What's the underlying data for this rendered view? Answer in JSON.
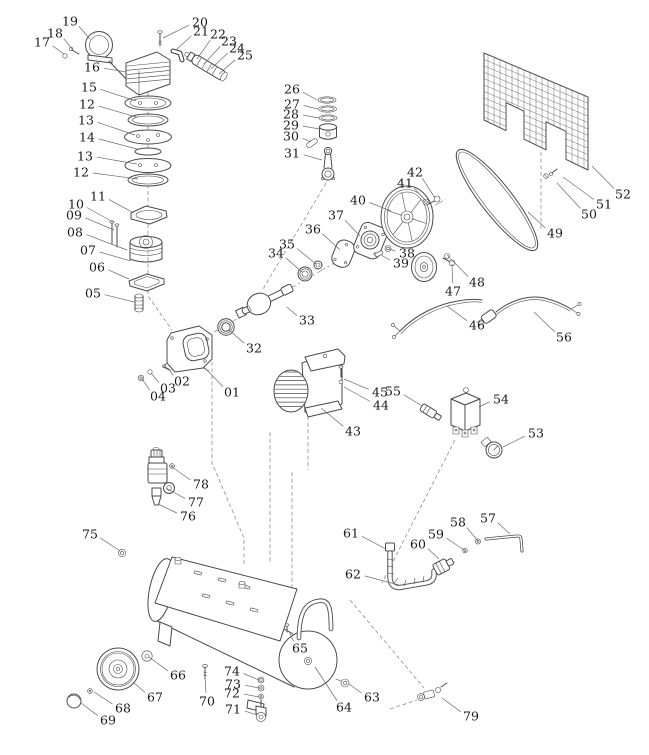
{
  "colors": {
    "line": "#4a4a4a",
    "dash": "#8f8f8f",
    "label": "#1a1a1a",
    "background": "#ffffff"
  },
  "labels": [
    {
      "t": "01",
      "x": 232,
      "y": 392,
      "tx": 204,
      "ty": 367
    },
    {
      "t": "02",
      "x": 182,
      "y": 381,
      "tx": 169,
      "ty": 369
    },
    {
      "t": "03",
      "x": 168,
      "y": 388,
      "tx": 151,
      "ty": 373
    },
    {
      "t": "04",
      "x": 158,
      "y": 396,
      "tx": 142,
      "ty": 379
    },
    {
      "t": "05",
      "x": 93,
      "y": 293,
      "tx": 134,
      "ty": 302
    },
    {
      "t": "06",
      "x": 97,
      "y": 267,
      "tx": 129,
      "ty": 279
    },
    {
      "t": "07",
      "x": 88,
      "y": 250,
      "tx": 131,
      "ty": 261
    },
    {
      "t": "08",
      "x": 75,
      "y": 232,
      "tx": 127,
      "ty": 250
    },
    {
      "t": "09",
      "x": 74,
      "y": 215,
      "tx": 114,
      "ty": 230
    },
    {
      "t": "10",
      "x": 76,
      "y": 204,
      "tx": 113,
      "ty": 222
    },
    {
      "t": "11",
      "x": 98,
      "y": 196,
      "tx": 132,
      "ty": 212
    },
    {
      "t": "12",
      "x": 87,
      "y": 104,
      "tx": 136,
      "ty": 117
    },
    {
      "t": "13",
      "x": 86,
      "y": 120,
      "tx": 135,
      "ty": 135
    },
    {
      "t": "14",
      "x": 87,
      "y": 137,
      "tx": 137,
      "ty": 149
    },
    {
      "t": "13",
      "x": 85,
      "y": 156,
      "tx": 137,
      "ty": 164
    },
    {
      "t": "12",
      "x": 81,
      "y": 172,
      "tx": 138,
      "ty": 179
    },
    {
      "t": "15",
      "x": 89,
      "y": 87,
      "tx": 136,
      "ty": 101
    },
    {
      "t": "16",
      "x": 92,
      "y": 67,
      "tx": 126,
      "ty": 72
    },
    {
      "t": "17",
      "x": 42,
      "y": 42,
      "tx": 64,
      "ty": 54
    },
    {
      "t": "18",
      "x": 55,
      "y": 33,
      "tx": 73,
      "ty": 50
    },
    {
      "t": "19",
      "x": 70,
      "y": 21,
      "tx": 90,
      "ty": 39
    },
    {
      "t": "20",
      "x": 200,
      "y": 22,
      "tx": 163,
      "ty": 38
    },
    {
      "t": "21",
      "x": 201,
      "y": 31,
      "tx": 176,
      "ty": 50
    },
    {
      "t": "22",
      "x": 218,
      "y": 34,
      "tx": 197,
      "ty": 59
    },
    {
      "t": "23",
      "x": 229,
      "y": 41,
      "tx": 204,
      "ty": 64
    },
    {
      "t": "24",
      "x": 237,
      "y": 48,
      "tx": 211,
      "ty": 69
    },
    {
      "t": "25",
      "x": 245,
      "y": 55,
      "tx": 219,
      "ty": 74
    },
    {
      "t": "26",
      "x": 292,
      "y": 89,
      "tx": 317,
      "ty": 100
    },
    {
      "t": "27",
      "x": 292,
      "y": 104,
      "tx": 318,
      "ty": 109
    },
    {
      "t": "28",
      "x": 291,
      "y": 114,
      "tx": 319,
      "ty": 118
    },
    {
      "t": "29",
      "x": 291,
      "y": 125,
      "tx": 320,
      "ty": 129
    },
    {
      "t": "30",
      "x": 291,
      "y": 136,
      "tx": 311,
      "ty": 142
    },
    {
      "t": "31",
      "x": 292,
      "y": 153,
      "tx": 322,
      "ty": 160
    },
    {
      "t": "32",
      "x": 254,
      "y": 348,
      "tx": 229,
      "ty": 330
    },
    {
      "t": "33",
      "x": 307,
      "y": 320,
      "tx": 287,
      "ty": 307
    },
    {
      "t": "34",
      "x": 276,
      "y": 253,
      "tx": 302,
      "ty": 272
    },
    {
      "t": "35",
      "x": 287,
      "y": 244,
      "tx": 316,
      "ty": 264
    },
    {
      "t": "36",
      "x": 313,
      "y": 229,
      "tx": 340,
      "ty": 250
    },
    {
      "t": "37",
      "x": 336,
      "y": 215,
      "tx": 360,
      "ty": 236
    },
    {
      "t": "38",
      "x": 407,
      "y": 253,
      "tx": 390,
      "ty": 249
    },
    {
      "t": "39",
      "x": 401,
      "y": 263,
      "tx": 381,
      "ty": 255
    },
    {
      "t": "40",
      "x": 358,
      "y": 200,
      "tx": 391,
      "ty": 211
    },
    {
      "t": "41",
      "x": 405,
      "y": 183,
      "tx": 425,
      "ty": 200
    },
    {
      "t": "42",
      "x": 415,
      "y": 172,
      "tx": 435,
      "ty": 198
    },
    {
      "t": "43",
      "x": 353,
      "y": 431,
      "tx": 321,
      "ty": 408
    },
    {
      "t": "44",
      "x": 381,
      "y": 405,
      "tx": 344,
      "ty": 387
    },
    {
      "t": "45",
      "x": 380,
      "y": 392,
      "tx": 344,
      "ty": 379
    },
    {
      "t": "46",
      "x": 477,
      "y": 325,
      "tx": 447,
      "ty": 306
    },
    {
      "t": "47",
      "x": 453,
      "y": 291,
      "tx": 452,
      "ty": 264
    },
    {
      "t": "48",
      "x": 477,
      "y": 282,
      "tx": 447,
      "ty": 255
    },
    {
      "t": "49",
      "x": 555,
      "y": 233,
      "tx": 528,
      "ty": 212
    },
    {
      "t": "50",
      "x": 589,
      "y": 214,
      "tx": 557,
      "ty": 183
    },
    {
      "t": "51",
      "x": 604,
      "y": 204,
      "tx": 563,
      "ty": 177
    },
    {
      "t": "52",
      "x": 623,
      "y": 194,
      "tx": 592,
      "ty": 166
    },
    {
      "t": "53",
      "x": 536,
      "y": 433,
      "tx": 503,
      "ty": 447
    },
    {
      "t": "54",
      "x": 501,
      "y": 399,
      "tx": 479,
      "ty": 407
    },
    {
      "t": "55",
      "x": 393,
      "y": 391,
      "tx": 422,
      "ty": 406
    },
    {
      "t": "56",
      "x": 564,
      "y": 337,
      "tx": 534,
      "ty": 312
    },
    {
      "t": "57",
      "x": 488,
      "y": 518,
      "tx": 510,
      "ty": 534
    },
    {
      "t": "58",
      "x": 458,
      "y": 522,
      "tx": 478,
      "ty": 541
    },
    {
      "t": "59",
      "x": 436,
      "y": 534,
      "tx": 464,
      "ty": 550
    },
    {
      "t": "60",
      "x": 418,
      "y": 544,
      "tx": 439,
      "ty": 559
    },
    {
      "t": "61",
      "x": 351,
      "y": 533,
      "tx": 386,
      "ty": 549
    },
    {
      "t": "62",
      "x": 353,
      "y": 574,
      "tx": 399,
      "ty": 585
    },
    {
      "t": "63",
      "x": 372,
      "y": 697,
      "tx": 349,
      "ty": 684
    },
    {
      "t": "64",
      "x": 344,
      "y": 707,
      "tx": 315,
      "ty": 667
    },
    {
      "t": "65",
      "x": 300,
      "y": 648,
      "tx": 289,
      "ty": 631
    },
    {
      "t": "66",
      "x": 178,
      "y": 675,
      "tx": 149,
      "ty": 657
    },
    {
      "t": "67",
      "x": 155,
      "y": 697,
      "tx": 133,
      "ty": 682
    },
    {
      "t": "68",
      "x": 123,
      "y": 708,
      "tx": 94,
      "ty": 692
    },
    {
      "t": "69",
      "x": 108,
      "y": 720,
      "tx": 81,
      "ty": 703
    },
    {
      "t": "70",
      "x": 207,
      "y": 701,
      "tx": 205,
      "ty": 676
    },
    {
      "t": "71",
      "x": 233,
      "y": 709,
      "tx": 257,
      "ty": 715
    },
    {
      "t": "72",
      "x": 232,
      "y": 693,
      "tx": 259,
      "ty": 697
    },
    {
      "t": "73",
      "x": 233,
      "y": 684,
      "tx": 259,
      "ty": 688
    },
    {
      "t": "74",
      "x": 232,
      "y": 671,
      "tx": 259,
      "ty": 680
    },
    {
      "t": "75",
      "x": 90,
      "y": 534,
      "tx": 120,
      "ty": 551
    },
    {
      "t": "76",
      "x": 188,
      "y": 516,
      "tx": 158,
      "ty": 504
    },
    {
      "t": "77",
      "x": 196,
      "y": 502,
      "tx": 166,
      "ty": 488
    },
    {
      "t": "78",
      "x": 201,
      "y": 484,
      "tx": 172,
      "ty": 467
    },
    {
      "t": "79",
      "x": 471,
      "y": 716,
      "tx": 442,
      "ty": 698
    }
  ]
}
